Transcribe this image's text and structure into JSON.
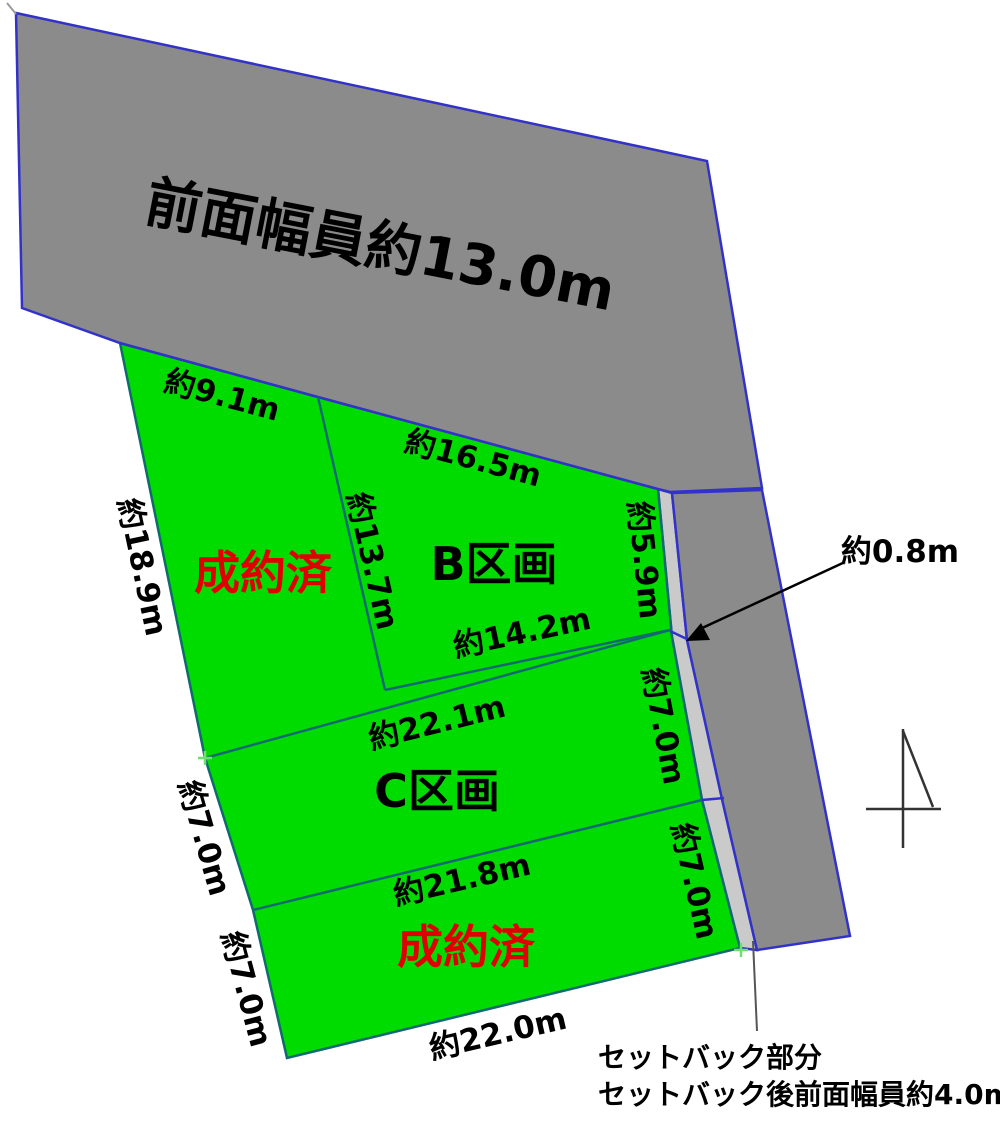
{
  "road": {
    "width_label": "前面幅員約13.0m"
  },
  "plots": {
    "a_status": "成約済",
    "b_name": "B区画",
    "c_name": "C区画",
    "d_status": "成約済"
  },
  "dimensions": {
    "a_frontage": "約9.1m",
    "b_frontage": "約16.5m",
    "a_west": "約18.9m",
    "a_b_boundary": "約13.7m",
    "b_east": "約5.9m",
    "b_south": "約14.2m",
    "setback_depth": "約0.8m",
    "c_north": "約22.1m",
    "c_west": "約7.0m",
    "c_east": "約7.0m",
    "c_south": "約21.8m",
    "d_west": "約7.0m",
    "d_east": "約7.0m",
    "d_south": "約22.0m"
  },
  "annotations": {
    "setback_part": "セットバック部分",
    "setback_after": "セットバック後前面幅員約4.0m"
  },
  "colors": {
    "road_fill": "#8b8b8b",
    "plot_fill": "#00dc00",
    "setback_fill": "#cacaca",
    "road_border": "#3232c8",
    "plot_border": "#116a70",
    "sold_text": "#e00000",
    "label_text": "#000000"
  }
}
